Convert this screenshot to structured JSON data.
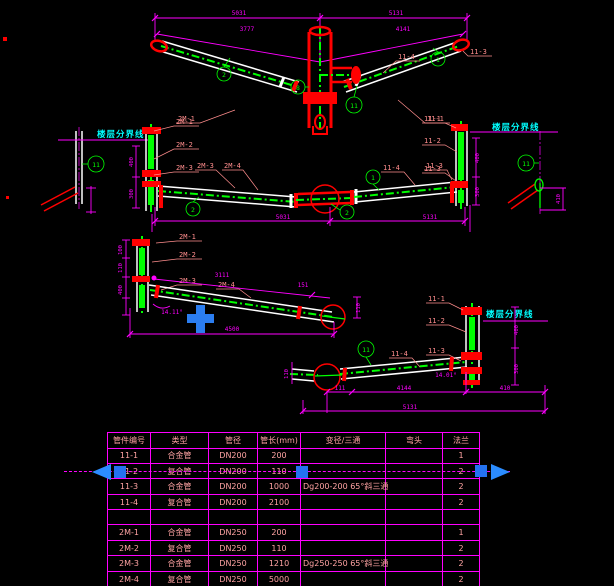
{
  "colors": {
    "background": "#000000",
    "dimension": "#ff00ff",
    "pipe_outline": "#ffffff",
    "centerline": "#00ff00",
    "fitting": "#ff0000",
    "label": "#ff8d8d",
    "floor_text": "#00ffff",
    "table_grid": "#ff00ff",
    "table_text": "#ffa3a3",
    "grip": "#2472f0",
    "cursor": "#2b7df0"
  },
  "top_view": {
    "dims": {
      "total_left": "5031",
      "total_right": "5131",
      "inner_left": "3777",
      "inner_right": "4141"
    },
    "labels": {
      "left_end": "2M-1",
      "bottom_right": "11-1",
      "right_arm": "11-4",
      "right_end": "11-3"
    },
    "balloons": {
      "left_arm": "2",
      "column": "8",
      "branch": "11",
      "right_arm": "1"
    }
  },
  "elevation_view": {
    "floor_line_left": "楼层分界线",
    "floor_line_right": "楼层分界线",
    "left_riser_labels": [
      "2M-1",
      "2M-2",
      "2M-3"
    ],
    "right_riser_labels": [
      "11-1",
      "11-2",
      "11-3"
    ],
    "pipe_label_1": "2M-3",
    "pipe_label_2": "2M-4",
    "pipe_label_3": "11-4",
    "pipe_label_4": "11-3",
    "balloons": {
      "left_bracket": "11",
      "pipe_left": "2",
      "pipe_center": "2",
      "pipe_right": "1",
      "right_bracket": "11"
    },
    "dims": {
      "left": "5031",
      "right": "5131",
      "left_riser": [
        "400",
        "300"
      ],
      "right_riser": [
        "400",
        "300"
      ],
      "bracket_right": "410"
    }
  },
  "detail_left_view": {
    "labels": [
      "2M-1",
      "2M-2",
      "2M-3",
      "2M-4"
    ],
    "angle": "14.11°",
    "dims": {
      "top": "3111",
      "tick": "151",
      "bottom": "4500",
      "side": "110",
      "riser": [
        "100",
        "110",
        "400"
      ]
    }
  },
  "detail_right_view": {
    "labels": [
      "11-1",
      "11-2",
      "11-3",
      "11-4"
    ],
    "balloon": "11",
    "floor_line": "楼层分界线",
    "angle": "14.01°",
    "dims": {
      "stub": "110",
      "seg1": "111",
      "seg2": "4144",
      "seg3": "410",
      "total": "5131",
      "riser": [
        "400",
        "300"
      ]
    }
  },
  "table": {
    "headers": [
      "管件编号",
      "类型",
      "管径",
      "管长(mm)",
      "变径/三通",
      "弯头",
      "法兰"
    ],
    "rows": [
      [
        "11-1",
        "合金管",
        "DN200",
        "200",
        "",
        "",
        "1"
      ],
      [
        "11-2",
        "复合管",
        "DN200",
        "110",
        "",
        "",
        "2"
      ],
      [
        "11-3",
        "合金管",
        "DN200",
        "1000",
        "Dg200-200  65°斜三通",
        "",
        "2"
      ],
      [
        "11-4",
        "复合管",
        "DN200",
        "2100",
        "",
        "",
        "2"
      ],
      [
        "",
        "",
        "",
        "",
        "",
        "",
        ""
      ],
      [
        "2M-1",
        "合金管",
        "DN250",
        "200",
        "",
        "",
        "1"
      ],
      [
        "2M-2",
        "复合管",
        "DN250",
        "110",
        "",
        "",
        "2"
      ],
      [
        "2M-3",
        "合金管",
        "DN250",
        "1210",
        "Dg250-250  65°斜三通",
        "",
        "2"
      ],
      [
        "2M-4",
        "复合管",
        "DN250",
        "5000",
        "",
        "",
        "2"
      ]
    ]
  }
}
